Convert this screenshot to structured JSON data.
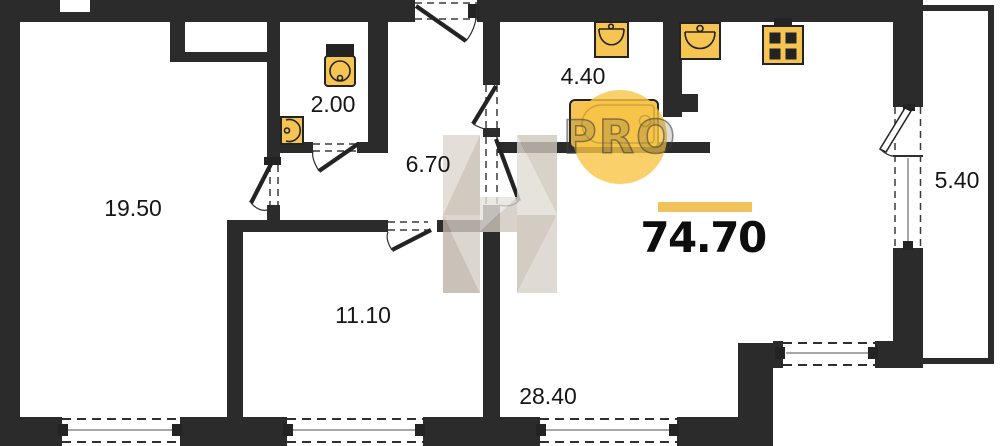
{
  "plan": {
    "type": "apartment-floor-plan",
    "total_area": "74.70",
    "rooms": [
      {
        "id": "living-room",
        "area": "19.50"
      },
      {
        "id": "wc",
        "area": "2.00"
      },
      {
        "id": "hallway",
        "area": "6.70"
      },
      {
        "id": "bathroom",
        "area": "4.40"
      },
      {
        "id": "bedroom",
        "area": "11.10"
      },
      {
        "id": "kitchen-living-room",
        "area": "28.40"
      },
      {
        "id": "balcony",
        "area": "5.40"
      }
    ],
    "fixtures": [
      "toilet",
      "corner-sink",
      "washbasin",
      "bathtub",
      "kitchen-sink",
      "stove"
    ]
  },
  "watermark": {
    "logo_text": "PRO"
  },
  "colors": {
    "wall": "#2b2b2b",
    "fixture": "#f6c453",
    "watermark_circle": "#f7c445",
    "accent_bar": "#f2c35c",
    "watermark_taupe": "#c9c0b4"
  }
}
